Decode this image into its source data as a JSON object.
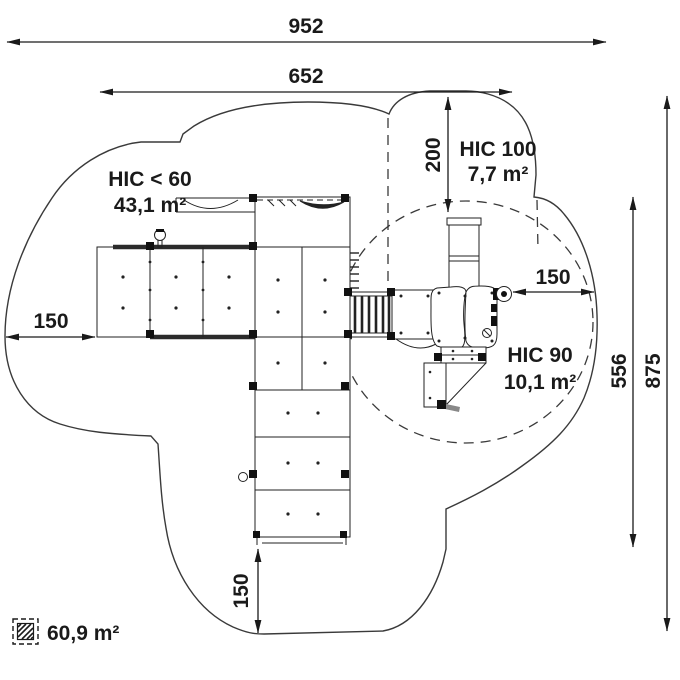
{
  "dimensions": {
    "overall_width": "952",
    "inner_width": "652",
    "top_zone_height": "200",
    "left_clearance": "150",
    "right_clearance": "150",
    "bottom_clearance": "150",
    "right_inner_height": "556",
    "overall_height": "875"
  },
  "zones": {
    "hic_60": {
      "label": "HIC < 60",
      "area": "43,1 m²"
    },
    "hic_100": {
      "label": "HIC 100",
      "area": "7,7 m²"
    },
    "hic_90": {
      "label": "HIC 90",
      "area": "10,1 m²"
    }
  },
  "legend": {
    "total_area": "60,9 m²"
  },
  "colors": {
    "line": "#1a1a1a",
    "background": "#ffffff"
  }
}
